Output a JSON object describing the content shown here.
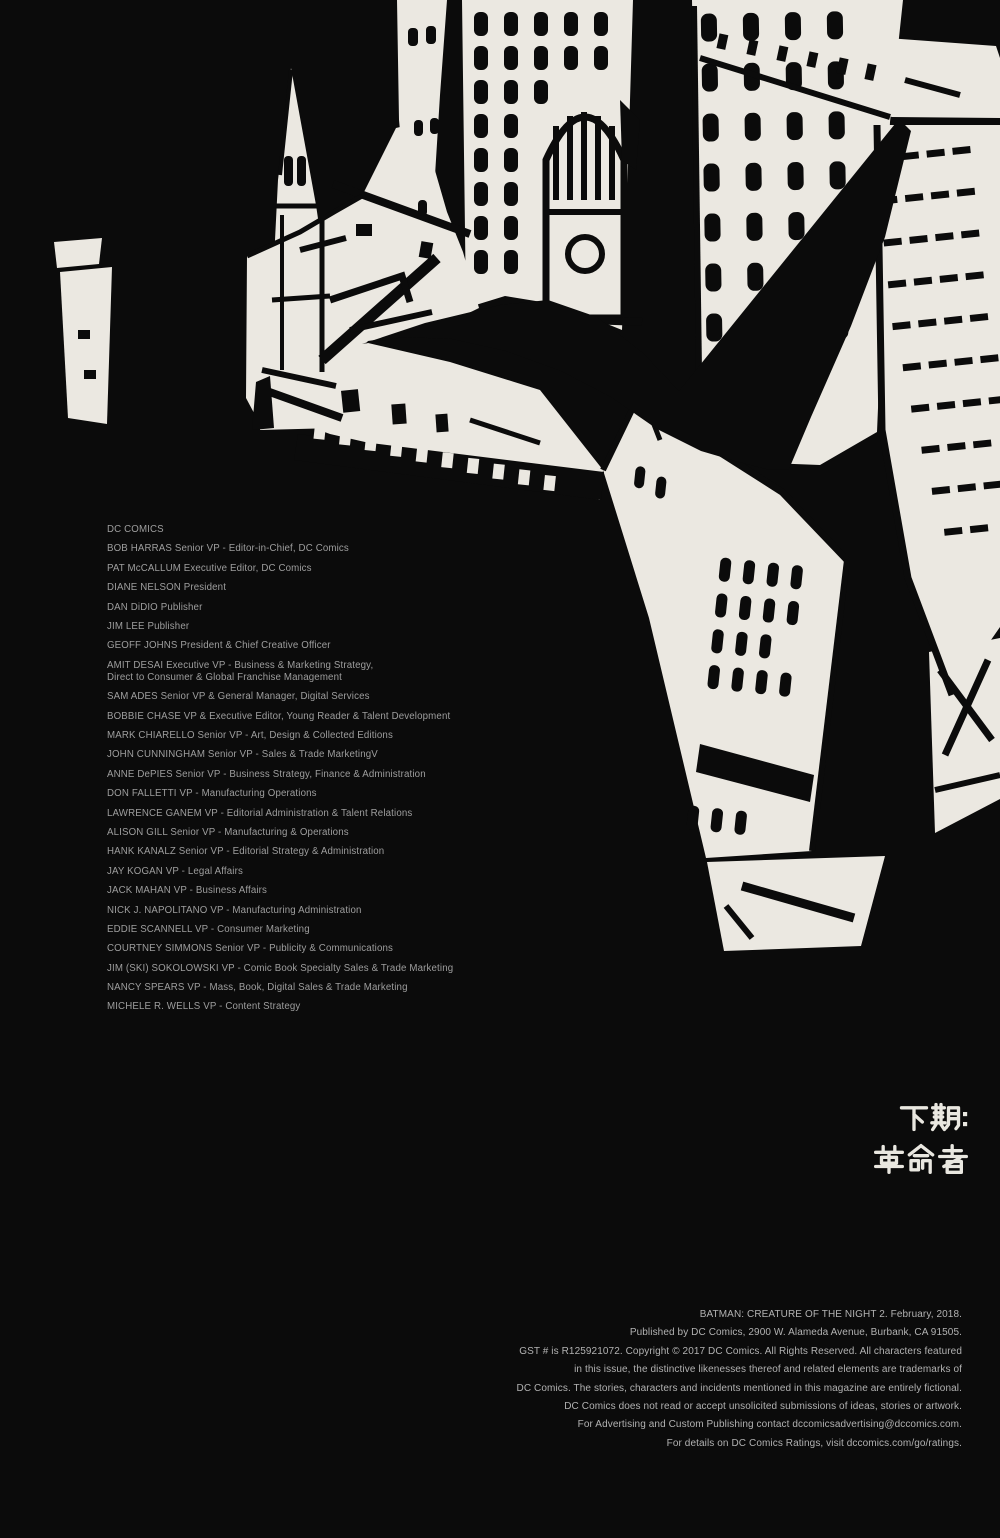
{
  "page": {
    "background_color": "#0b0b0b",
    "paper_color": "#ebe8e1",
    "credits_color": "#9e9e9e",
    "legal_color": "#b2b2b2",
    "cjk_color": "#e9e7e0"
  },
  "artwork": {
    "description": "Black-and-white ink illustration: aerial view of a city with church spire, clock tower, skyscrapers with window grids, and a black bat-shaped silhouette gliding over the buildings"
  },
  "credits": {
    "entries": [
      "DC COMICS",
      "BOB HARRAS Senior VP - Editor-in-Chief, DC Comics",
      "PAT McCALLUM Executive Editor, DC Comics",
      "DIANE NELSON President",
      "DAN DiDIO Publisher",
      "JIM LEE Publisher",
      "GEOFF JOHNS President & Chief Creative Officer",
      "AMIT DESAI Executive VP - Business & Marketing Strategy,\nDirect to Consumer & Global Franchise Management",
      "SAM ADES Senior VP & General Manager, Digital Services",
      "BOBBIE CHASE VP & Executive Editor, Young Reader & Talent Development",
      "MARK CHIARELLO Senior VP - Art, Design & Collected Editions",
      "JOHN CUNNINGHAM Senior VP - Sales & Trade MarketingV",
      "ANNE DePIES Senior VP - Business Strategy, Finance & Administration",
      "DON FALLETTI VP - Manufacturing Operations",
      "LAWRENCE GANEM VP - Editorial Administration & Talent Relations",
      "ALISON GILL Senior VP - Manufacturing & Operations",
      "HANK KANALZ Senior VP - Editorial Strategy & Administration",
      "JAY KOGAN VP - Legal Affairs",
      "JACK MAHAN VP - Business Affairs",
      "NICK J. NAPOLITANO VP - Manufacturing Administration",
      "EDDIE SCANNELL VP - Consumer Marketing",
      "COURTNEY SIMMONS Senior VP - Publicity & Communications",
      "JIM (SKI) SOKOLOWSKI VP - Comic Book Specialty Sales & Trade Marketing",
      "NANCY SPEARS VP - Mass, Book, Digital Sales & Trade Marketing",
      "MICHELE R. WELLS VP - Content Strategy"
    ]
  },
  "next_issue": {
    "line1": "下期:",
    "line2": "革命者",
    "full": "下期: 革命者"
  },
  "legal": {
    "lines": [
      "BATMAN: CREATURE OF THE NIGHT 2. February, 2018.",
      "Published by DC Comics, 2900 W. Alameda Avenue, Burbank, CA 91505.",
      "GST # is R125921072. Copyright © 2017 DC Comics. All Rights Reserved. All characters featured",
      "in this issue, the distinctive likenesses thereof and related elements are trademarks of",
      "DC Comics. The stories, characters and incidents mentioned in this magazine are entirely fictional.",
      "DC Comics does not read or accept unsolicited submissions of ideas, stories or artwork.",
      "For Advertising and Custom Publishing contact dccomicsadvertising@dccomics.com.",
      "For details on DC Comics Ratings, visit dccomics.com/go/ratings."
    ]
  }
}
